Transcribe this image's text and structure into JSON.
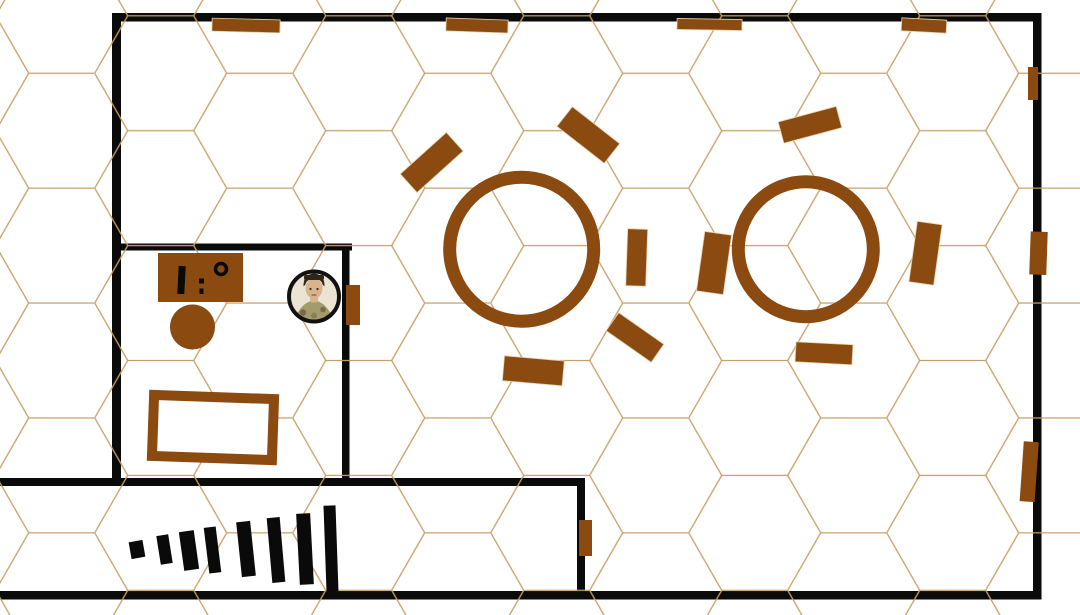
{
  "canvas": {
    "width": 1080,
    "height": 615
  },
  "colors": {
    "background": "#ffffff",
    "hex_line": "#c69f68",
    "wall": "#0a0a0a",
    "furniture": "#8a4a10",
    "furniture_edge": "#e6d3ae",
    "stairs": "#0a0a0a",
    "symbol": "#0a0a0a",
    "table_fill": "#ffffff",
    "token_ring": "#111111",
    "token_bg": "#ebe4d2",
    "token_skin": "#d8b48e",
    "token_hair": "#2e2419",
    "token_coat": "#a39a6e"
  },
  "grid": {
    "edge": 66,
    "tile_width": 198,
    "row_height": 114.9,
    "offset_x": 94.7,
    "offset_y": 15.8,
    "line_width": 1.3
  },
  "walls": [
    {
      "name": "wall-top",
      "x": 112,
      "y": 13,
      "w": 929.5,
      "h": 8.5
    },
    {
      "name": "wall-left",
      "x": 112,
      "y": 13,
      "w": 9,
      "h": 473
    },
    {
      "name": "wall-right",
      "x": 1033,
      "y": 13,
      "w": 8.5,
      "h": 586.5
    },
    {
      "name": "wall-bottom",
      "x": 0,
      "y": 591,
      "w": 1041.5,
      "h": 8.5
    },
    {
      "name": "wall-bar-top",
      "x": 112,
      "y": 243.5,
      "w": 240,
      "h": 7
    },
    {
      "name": "wall-bar-right",
      "x": 342,
      "y": 243.5,
      "w": 7.5,
      "h": 242.5
    },
    {
      "name": "wall-corridor-top",
      "x": 0,
      "y": 478,
      "w": 585,
      "h": 8
    },
    {
      "name": "wall-corridor-right",
      "x": 577,
      "y": 478,
      "w": 8,
      "h": 121.5
    }
  ],
  "round_tables": [
    {
      "name": "round-table-1",
      "cx": 521.7,
      "cy": 249.2,
      "r": 72,
      "stroke": 13
    },
    {
      "name": "round-table-2",
      "cx": 805.8,
      "cy": 249.2,
      "r": 67.5,
      "stroke": 13
    }
  ],
  "chairs": [
    {
      "name": "bench-top-1",
      "cx": 246,
      "cy": 25.5,
      "w": 68,
      "h": 13,
      "rot": 1.5
    },
    {
      "name": "bench-top-2",
      "cx": 477,
      "cy": 25.5,
      "w": 62,
      "h": 13,
      "rot": 2
    },
    {
      "name": "bench-top-3",
      "cx": 709.5,
      "cy": 24.5,
      "w": 65,
      "h": 11,
      "rot": 1
    },
    {
      "name": "bench-top-4",
      "cx": 924,
      "cy": 25.5,
      "w": 45,
      "h": 13,
      "rot": 3
    },
    {
      "name": "chair-table1-nw",
      "cx": 431.7,
      "cy": 162.5,
      "w": 62,
      "h": 25,
      "rot": -42
    },
    {
      "name": "chair-table1-ne",
      "cx": 588.3,
      "cy": 135,
      "w": 60,
      "h": 25,
      "rot": 38
    },
    {
      "name": "chair-table1-e",
      "cx": 636.7,
      "cy": 257.5,
      "w": 20,
      "h": 57,
      "rot": 2
    },
    {
      "name": "chair-between-tables",
      "cx": 714,
      "cy": 263,
      "w": 27,
      "h": 60,
      "rot": 8
    },
    {
      "name": "chair-table1-se",
      "cx": 635,
      "cy": 337.5,
      "w": 55,
      "h": 22,
      "rot": 35
    },
    {
      "name": "chair-table1-s",
      "cx": 533.3,
      "cy": 370.8,
      "w": 60,
      "h": 25,
      "rot": 5
    },
    {
      "name": "chair-table2-n",
      "cx": 810,
      "cy": 124.8,
      "w": 60,
      "h": 22,
      "rot": -15
    },
    {
      "name": "chair-table2-e",
      "cx": 925.5,
      "cy": 253.3,
      "w": 25,
      "h": 61,
      "rot": 8
    },
    {
      "name": "chair-table2-s",
      "cx": 824,
      "cy": 353.3,
      "w": 57,
      "h": 20,
      "rot": 3
    }
  ],
  "doors": [
    {
      "name": "door-bar-room",
      "x": 346,
      "y": 285,
      "w": 14,
      "h": 40,
      "rot": 0
    },
    {
      "name": "door-east-1",
      "x": 1028,
      "y": 67,
      "w": 10,
      "h": 33,
      "rot": 0
    },
    {
      "name": "door-east-2",
      "x": 1030,
      "y": 231.7,
      "w": 17,
      "h": 43,
      "rot": 2
    },
    {
      "name": "door-east-3",
      "x": 1021.7,
      "y": 441.7,
      "w": 15,
      "h": 60,
      "rot": 4
    },
    {
      "name": "door-corridor",
      "x": 579,
      "y": 520,
      "w": 13,
      "h": 36,
      "rot": 0
    }
  ],
  "bar": {
    "counter": {
      "x": 158,
      "y": 253,
      "w": 85,
      "h": 49
    },
    "stool": {
      "cx": 192.5,
      "cy": 327,
      "r": 22.5
    },
    "table_outline": {
      "x": 153,
      "y": 397,
      "w": 120,
      "h": 61,
      "stroke": 10,
      "rot": 2
    },
    "counter_items": {
      "bottle": {
        "x": 178,
        "y": 266,
        "w": 7,
        "h": 28,
        "rot": 3
      },
      "dots": [
        {
          "x": 199,
          "y": 278.5,
          "w": 5,
          "h": 5
        },
        {
          "x": 199.5,
          "y": 288.5,
          "w": 4,
          "h": 5.5
        }
      ],
      "mug_ring": {
        "cx": 221,
        "cy": 269,
        "r": 5.5,
        "stroke": 3.5
      }
    }
  },
  "stairs": [
    {
      "x": 130,
      "y": 541,
      "w": 14,
      "h": 17,
      "rot": -10
    },
    {
      "x": 158.5,
      "y": 535,
      "w": 12,
      "h": 29,
      "rot": -9
    },
    {
      "x": 181.5,
      "y": 531,
      "w": 15,
      "h": 39,
      "rot": -8
    },
    {
      "x": 206.5,
      "y": 527,
      "w": 12,
      "h": 46,
      "rot": -7
    },
    {
      "x": 239,
      "y": 521.5,
      "w": 14,
      "h": 55,
      "rot": -6
    },
    {
      "x": 269.5,
      "y": 517.5,
      "w": 13,
      "h": 65,
      "rot": -5
    },
    {
      "x": 298,
      "y": 513.5,
      "w": 14,
      "h": 71,
      "rot": -3
    },
    {
      "x": 325,
      "y": 505.5,
      "w": 12,
      "h": 86,
      "rot": -2
    }
  ],
  "token": {
    "cx": 314,
    "cy": 296.5,
    "r": 27,
    "ring_width": 4
  }
}
